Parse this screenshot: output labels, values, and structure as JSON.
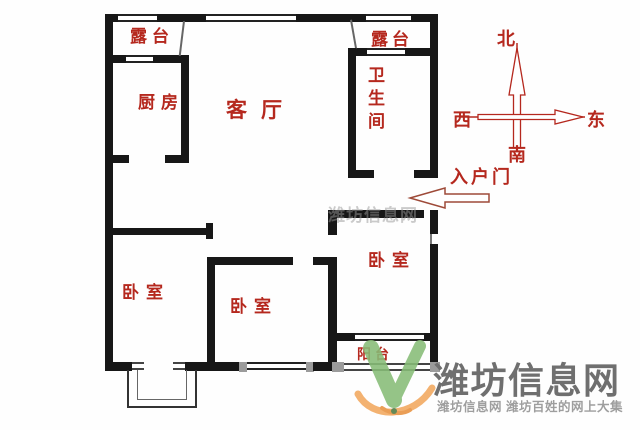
{
  "plan": {
    "rooms": {
      "terrace_left": "露台",
      "terrace_right": "露台",
      "kitchen": "厨房",
      "living_room": "客厅",
      "bathroom": "卫生间",
      "bedroom_left": "卧室",
      "bedroom_middle": "卧室",
      "bedroom_right": "卧室",
      "balcony": "阳台"
    },
    "entrance_label": "入户门",
    "compass": {
      "north": "北",
      "west": "西",
      "east": "东",
      "south": "南"
    }
  },
  "watermark": {
    "logo_text_large": "潍坊信息网",
    "tagline": "潍坊信息网 潍坊百姓的网上大集",
    "faint_overlay": "潍坊信息网"
  },
  "colors": {
    "wall": "#171717",
    "label_red": "#b5281e",
    "watermark_dark_gray": "#6f6f6f",
    "watermark_light_gray": "#9e9e9e",
    "logo_green": "#87bd77",
    "logo_orange": "#f2a85e"
  }
}
